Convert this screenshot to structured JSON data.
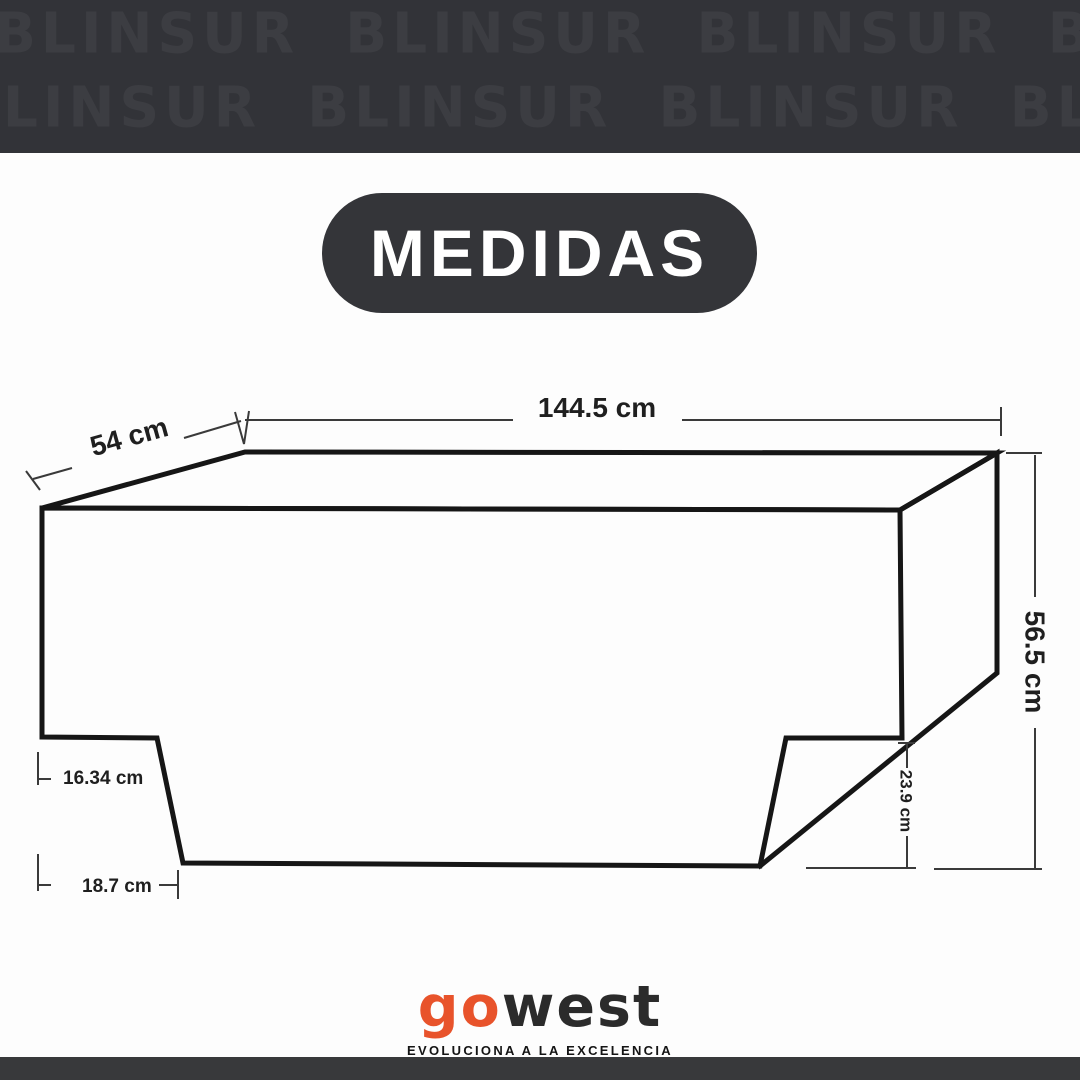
{
  "watermark": {
    "brand": "BLINSUR",
    "row1": "BLINSUR BLINSUR BLINSUR BLINSUR",
    "row2": "BLINSUR BLINSUR BLINSUR BLINSUR"
  },
  "header": {
    "title": "MEDIDAS"
  },
  "diagram": {
    "type": "technical-drawing",
    "object": "3D cargo-cover box with dimension callouts",
    "dimensions": {
      "top_width": "144.5 cm",
      "depth": "54 cm",
      "height": "56.5 cm",
      "right_notch_height": "23.9 cm",
      "left_upper_offset": "16.34 cm",
      "left_lower_offset": "18.7 cm"
    }
  },
  "footer": {
    "logo_go": "go",
    "logo_west": "west",
    "tagline": "EVOLUCIONA A LA EXCELENCIA"
  },
  "colors": {
    "band_background": "#323338",
    "watermark_text": "#3C3D42",
    "badge_background": "#343539",
    "badge_text": "#FFFFFF",
    "drawing_line": "#161616",
    "dimension_line": "#3A3A3A",
    "label_text": "#1F1F1F",
    "logo_orange": "#E8532B",
    "logo_dark": "#2B2B2B",
    "footer_band": "#38393B",
    "page_background": "#FDFDFD"
  }
}
